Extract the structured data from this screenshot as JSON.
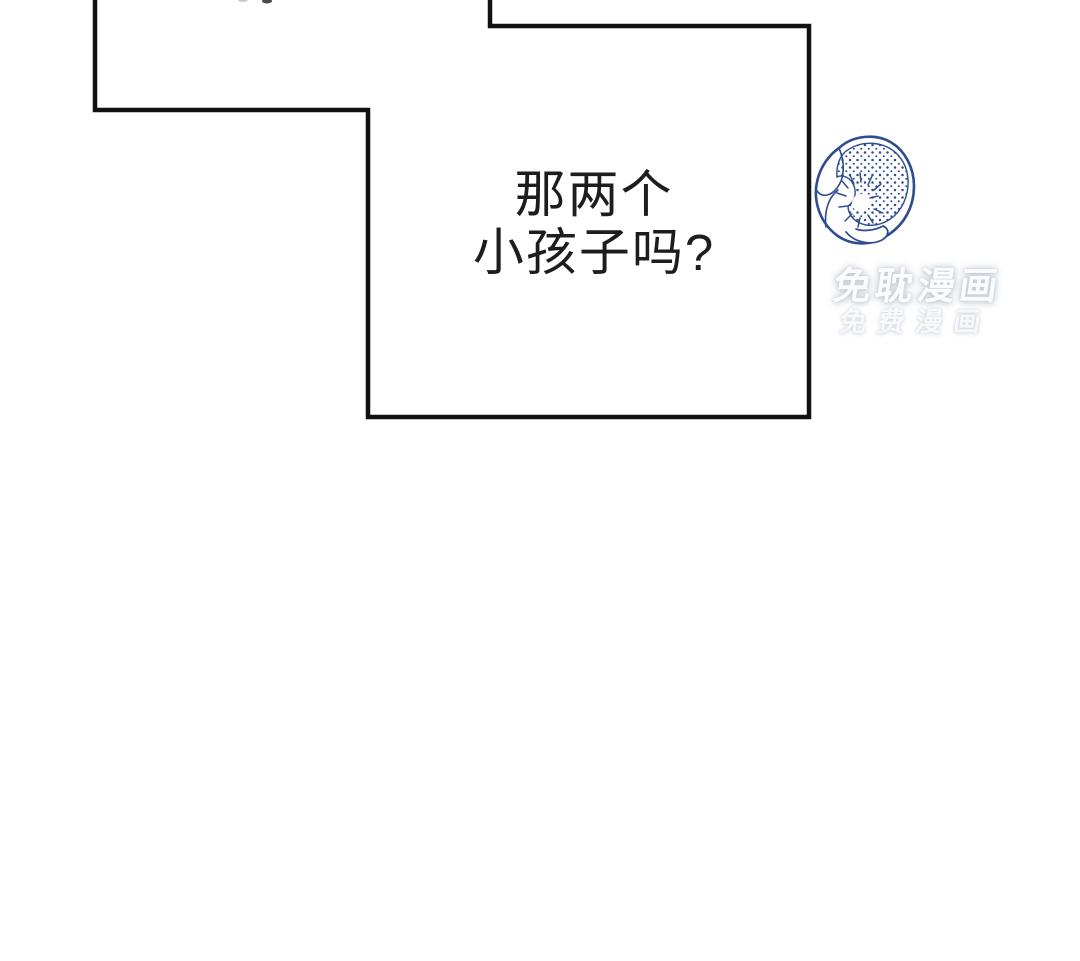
{
  "page": {
    "background_color": "#ffffff"
  },
  "panel": {
    "border_color": "#111111",
    "border_width": "4.5"
  },
  "dialogue": {
    "line1": "那两个",
    "line2": "小孩子吗?",
    "text_color": "#1d1d1d"
  },
  "watermark": {
    "line1": "免耽漫画",
    "line2": "免费漫画",
    "glyph_color": "#fafbfd",
    "shadow_color": "#c1c7d2"
  },
  "flower": {
    "icon": "blue-ink-flower-sketch",
    "ink_color": "#2e4c8f"
  },
  "fragments": {
    "top_edge_mark_color": "#4a4a4a"
  }
}
